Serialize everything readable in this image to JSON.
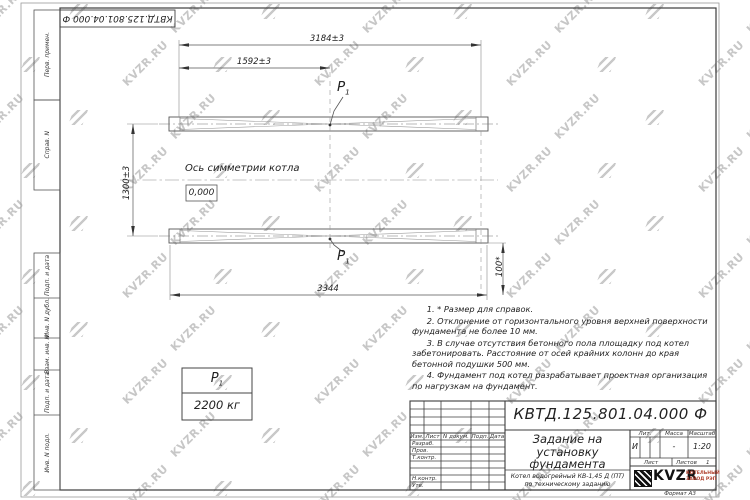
{
  "watermark": {
    "text": "KVZR.RU"
  },
  "frame": {
    "stamp_top": "КВТД.125.801.04.000  Ф",
    "margin_boxes": [
      "Перв. примен.",
      "Справ. N",
      "Подп. и дата",
      "Инв. N дубл.",
      "Взам. инв. N",
      "Подп. и дата",
      "Инв. N подл."
    ]
  },
  "drawing": {
    "dim_3184": "3184±3",
    "dim_1592": "1592±3",
    "dim_1300": "1300±3",
    "dim_3344": "3344",
    "dim_100": "100*",
    "axis_label": "Ось симметрии котла",
    "level_mark": "0,000",
    "load_point": "P",
    "load_point_sub": "1",
    "load_table_value": "2200 кг"
  },
  "notes": [
    "1. * Размер для справок.",
    "2. Отклонение от горизонтального уровня верхней поверхности фундамента не более 10 мм.",
    "3. В случае отсутствия бетонного пола площадку под котел забетонировать. Расстояние от осей крайних колонн до края бетонной подушки 500 мм.",
    "4. Фундамент под котел разрабатывает проектная организация по нагрузкам на фундамент."
  ],
  "title_block": {
    "doc_number": "КВТД.125.801.04.000  Ф",
    "title_line1": "Задание на",
    "title_line2": "установку",
    "title_line3": "фундамента",
    "product_line1": "Котел водогрейный КВ-1,45 Д (ПТ)",
    "product_line2": "по техническому заданию",
    "col_izm": "Изм.",
    "col_list": "Лист",
    "col_ndoc": "N докум.",
    "col_podp": "Подп.",
    "col_data": "Дата",
    "row_razrab": "Разраб.",
    "row_prov": "Пров.",
    "row_tkontr": "Т.контр.",
    "row_nkontr": "Н.контр.",
    "row_utv": "Утв.",
    "lit_label": "Лит.",
    "lit_value": "И",
    "mass_label": "Масса",
    "mass_value": "-",
    "scale_label": "Масштаб",
    "scale_value": "1:20",
    "sheet_label": "Лист",
    "sheets_label": "Листов",
    "sheets_value": "1",
    "logo_text": "KVZR",
    "logo_caption1": "КОТЕЛЬНЫЙ",
    "logo_caption2": "ЗАВОД РЭП",
    "format_label": "Формат А3"
  }
}
